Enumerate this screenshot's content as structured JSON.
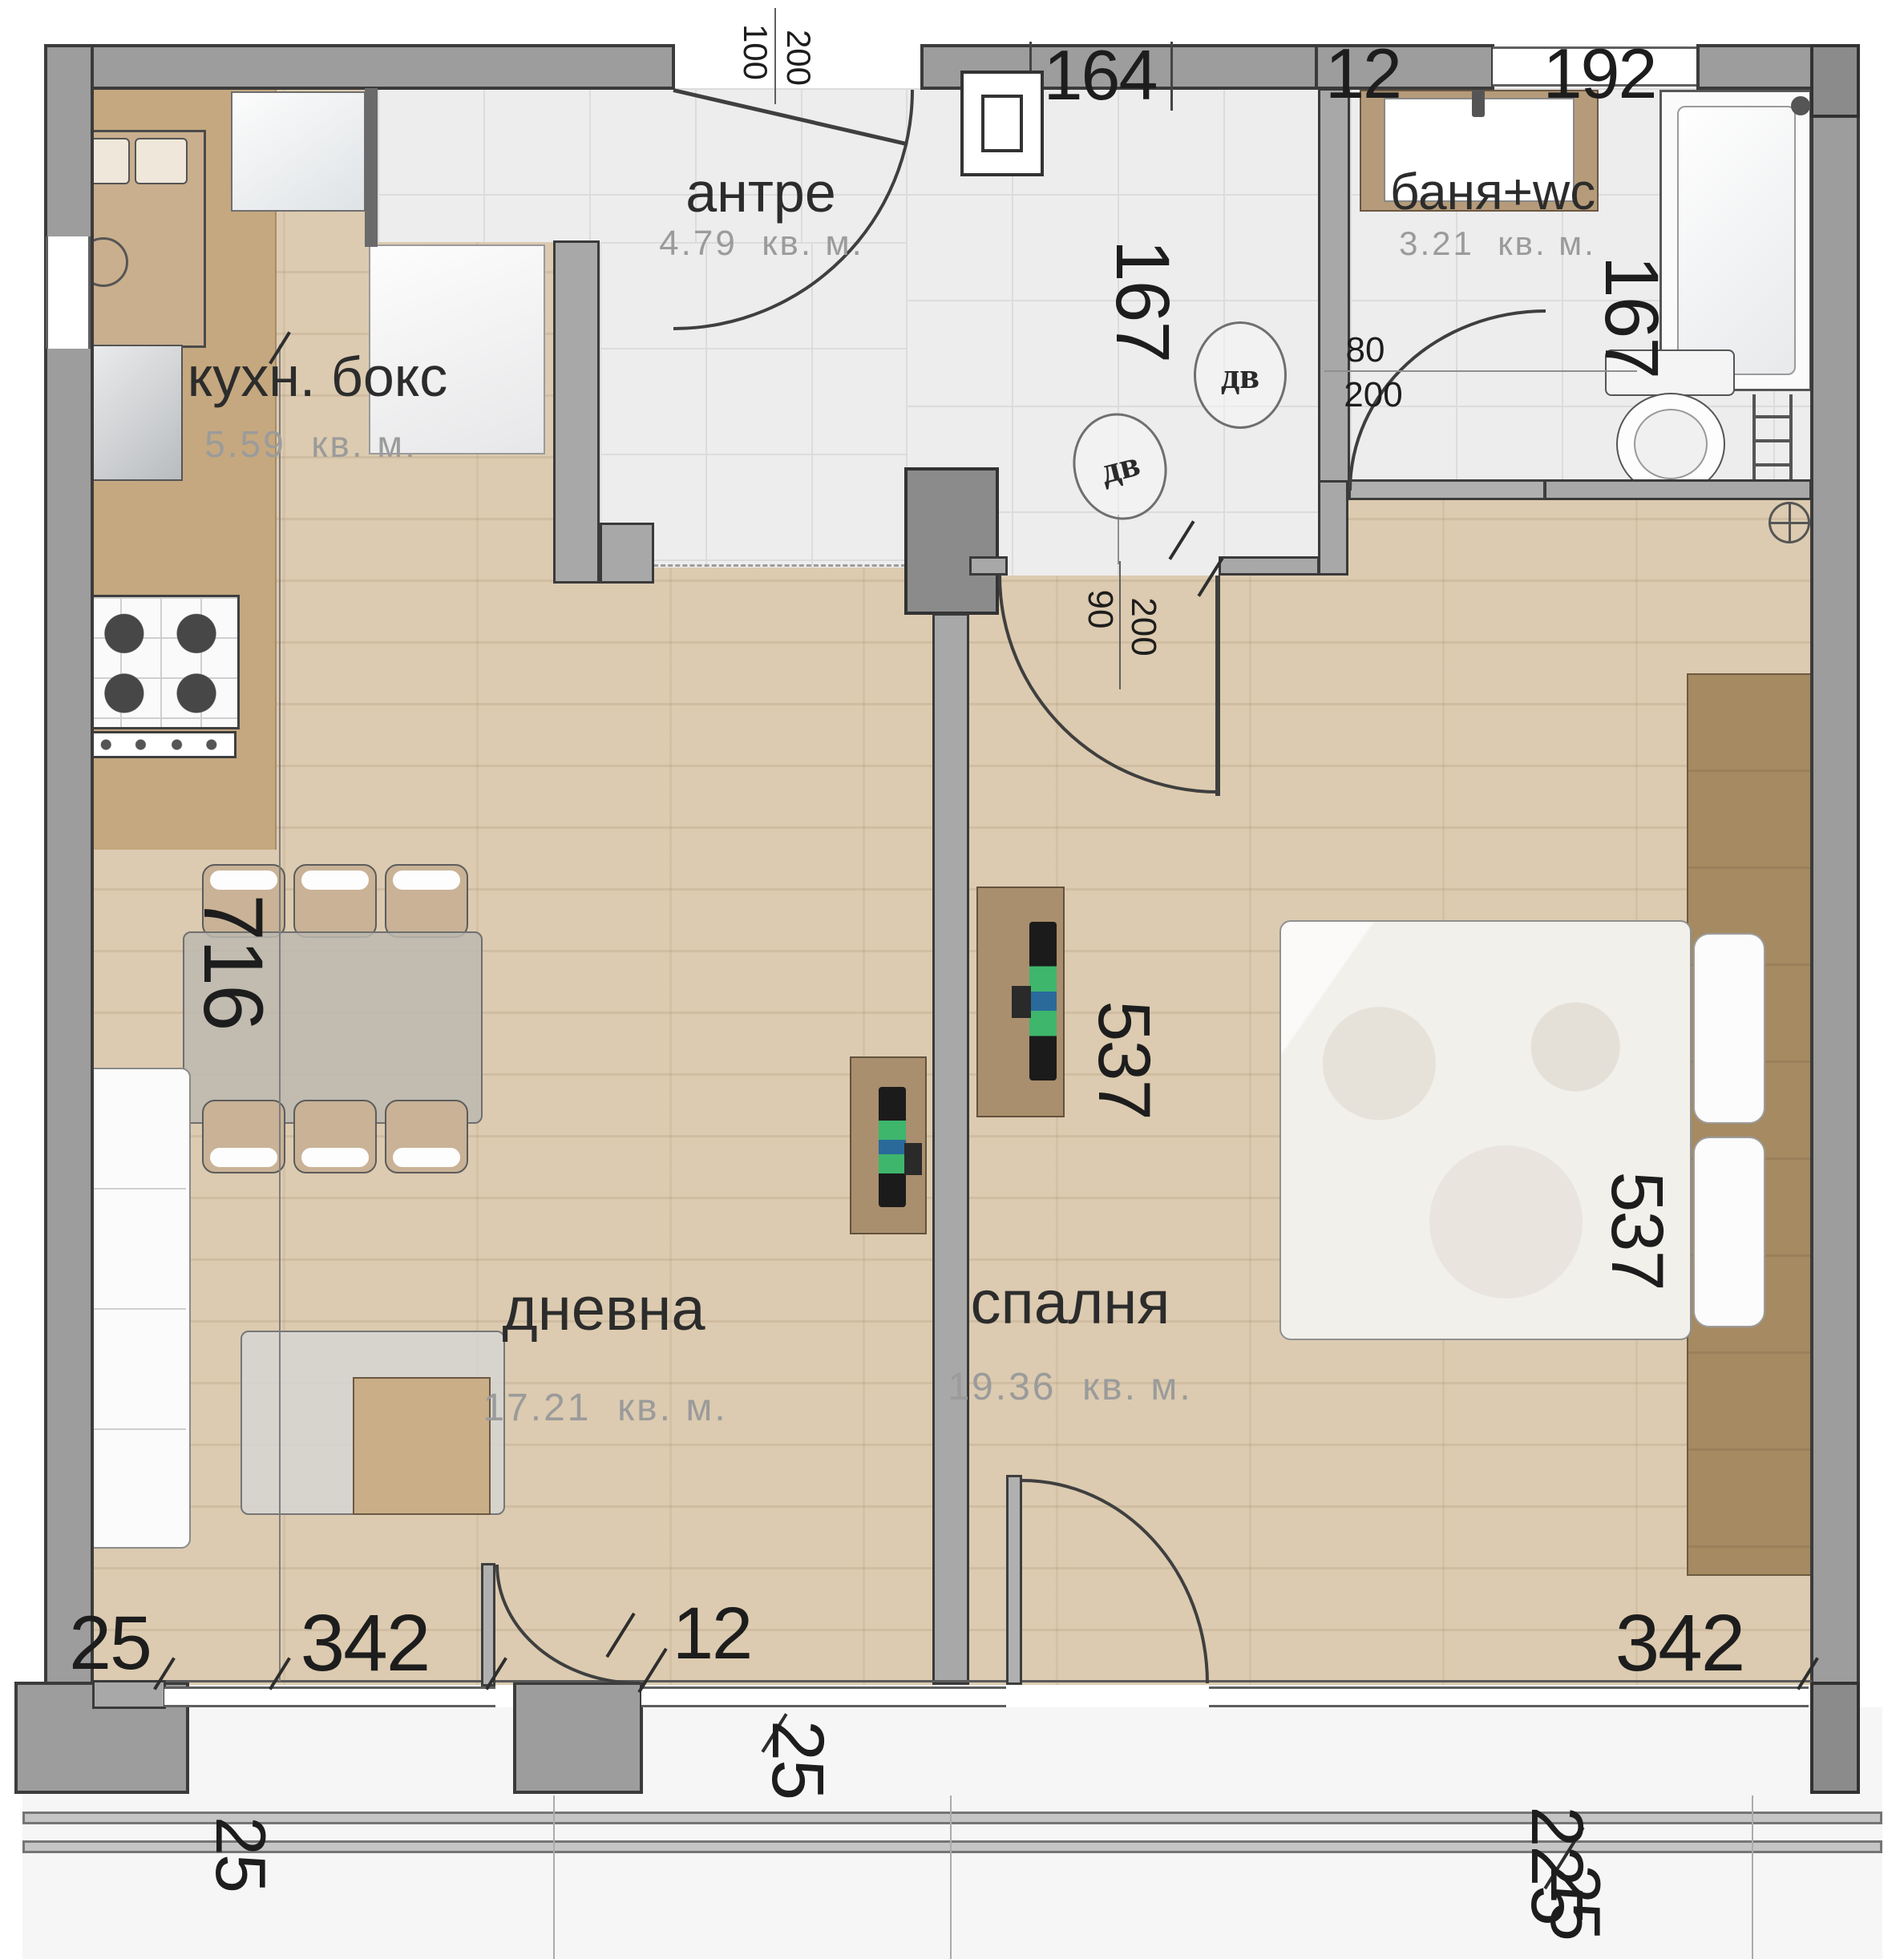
{
  "plan": {
    "kind": "apartment floor plan",
    "language": "bulgarian",
    "colors": {
      "wall": "#9d9d9d",
      "wood_floor": "#dccbb0",
      "tile_floor": "#ededee",
      "cabinet_wood": "#a98f6d",
      "tv_glow_green": "#40be70",
      "tv_glow_blue": "#2a6ea2"
    }
  },
  "rooms": [
    {
      "name": "кухн. бокс",
      "area": "5.59",
      "unit": "кв. м."
    },
    {
      "name": "антре",
      "area": "4.79",
      "unit": "кв. м."
    },
    {
      "name": "баня+wc",
      "area": "3.21",
      "unit": "кв. м."
    },
    {
      "name": "дневна",
      "area": "17.21",
      "unit": "кв. м."
    },
    {
      "name": "спалня",
      "area": "19.36",
      "unit": "кв. м."
    }
  ],
  "dims": {
    "left_total": "716",
    "hall_depth": "167",
    "bath_depth": "167",
    "bedroom_left": "537",
    "bedroom_right": "537",
    "living_width": "342",
    "bedroom_width": "342",
    "bottom_left_wall": "25",
    "bottom_left_wall_v": "25",
    "mid_gap": "12",
    "mid_wall_v": "25",
    "br_balcony": "225",
    "br_balcony_small": "25",
    "top_hall": "164",
    "top_gap": "12",
    "top_window": "192"
  },
  "doors": {
    "entry": {
      "w": "100",
      "h": "200"
    },
    "bath": {
      "label": "дв",
      "w": "80",
      "h": "200"
    },
    "bedroom": {
      "label": "дв",
      "w": "90",
      "h": "200"
    }
  }
}
